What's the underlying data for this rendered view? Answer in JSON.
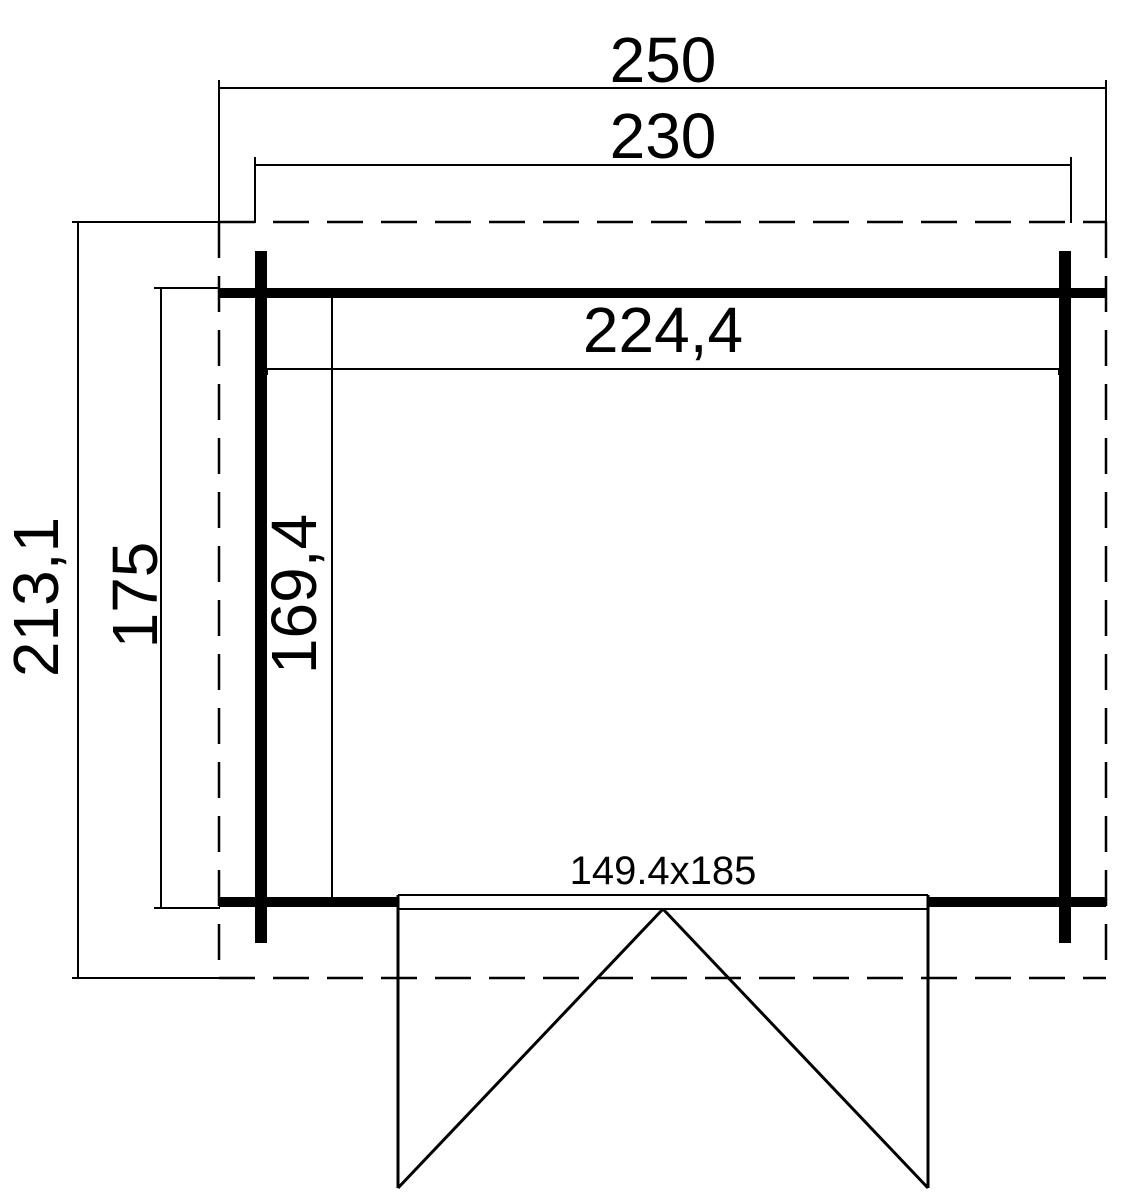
{
  "drawing": {
    "type": "floor-plan",
    "colors": {
      "background": "#ffffff",
      "line": "#000000"
    },
    "labels": {
      "overall_width": "250",
      "outer_wall_width": "230",
      "overall_depth": "213,1",
      "outer_wall_depth": "175",
      "interior_width": "224,4",
      "interior_depth": "169,4",
      "door_size": "149.4x185"
    }
  }
}
